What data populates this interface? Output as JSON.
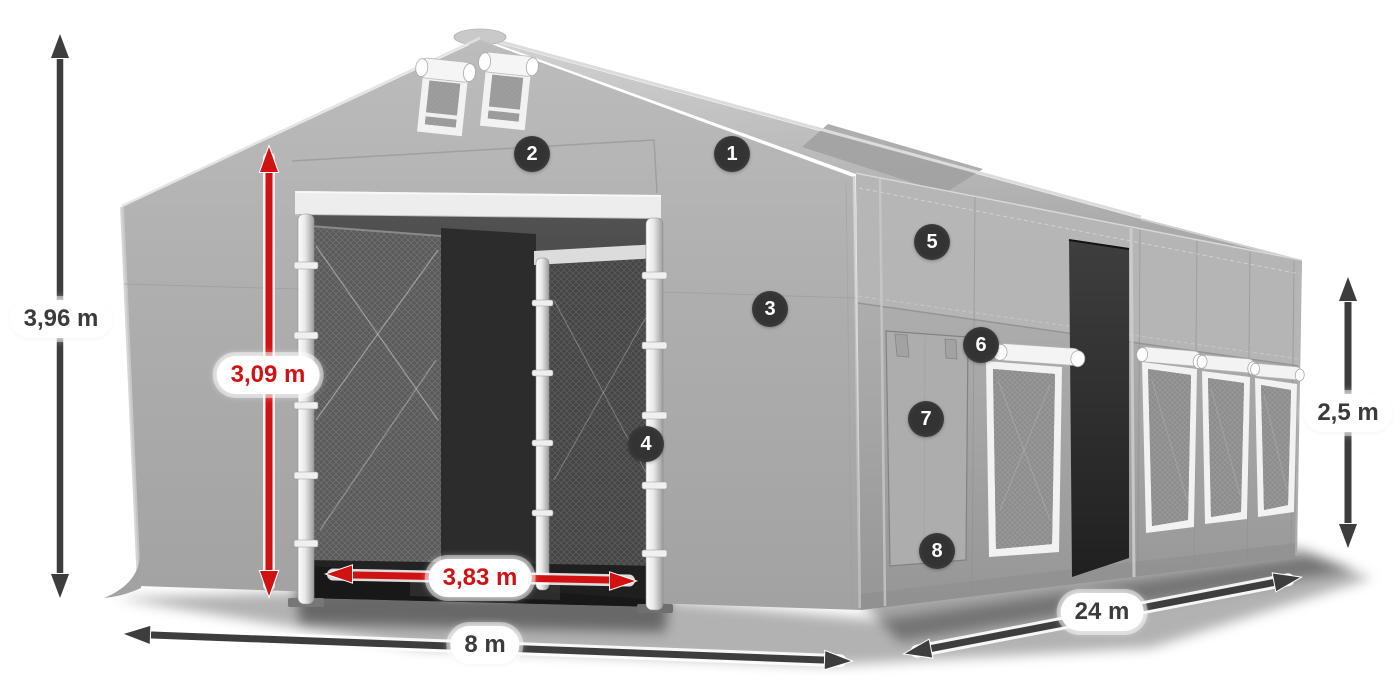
{
  "diagram_title": "Storage tent dimension diagram",
  "dimensions": {
    "total_height": "3,96 m",
    "door_height": "3,09 m",
    "door_width": "3,83 m",
    "front_width": "8 m",
    "length": "24 m",
    "side_height": "2,5 m"
  },
  "markers": [
    "1",
    "2",
    "3",
    "4",
    "5",
    "6",
    "7",
    "8"
  ],
  "colors": {
    "accent_red": "#d11212",
    "dimension_dark": "#3b3b3b",
    "badge_background": "#333333",
    "tent_fabric": "#aaaaaa"
  }
}
